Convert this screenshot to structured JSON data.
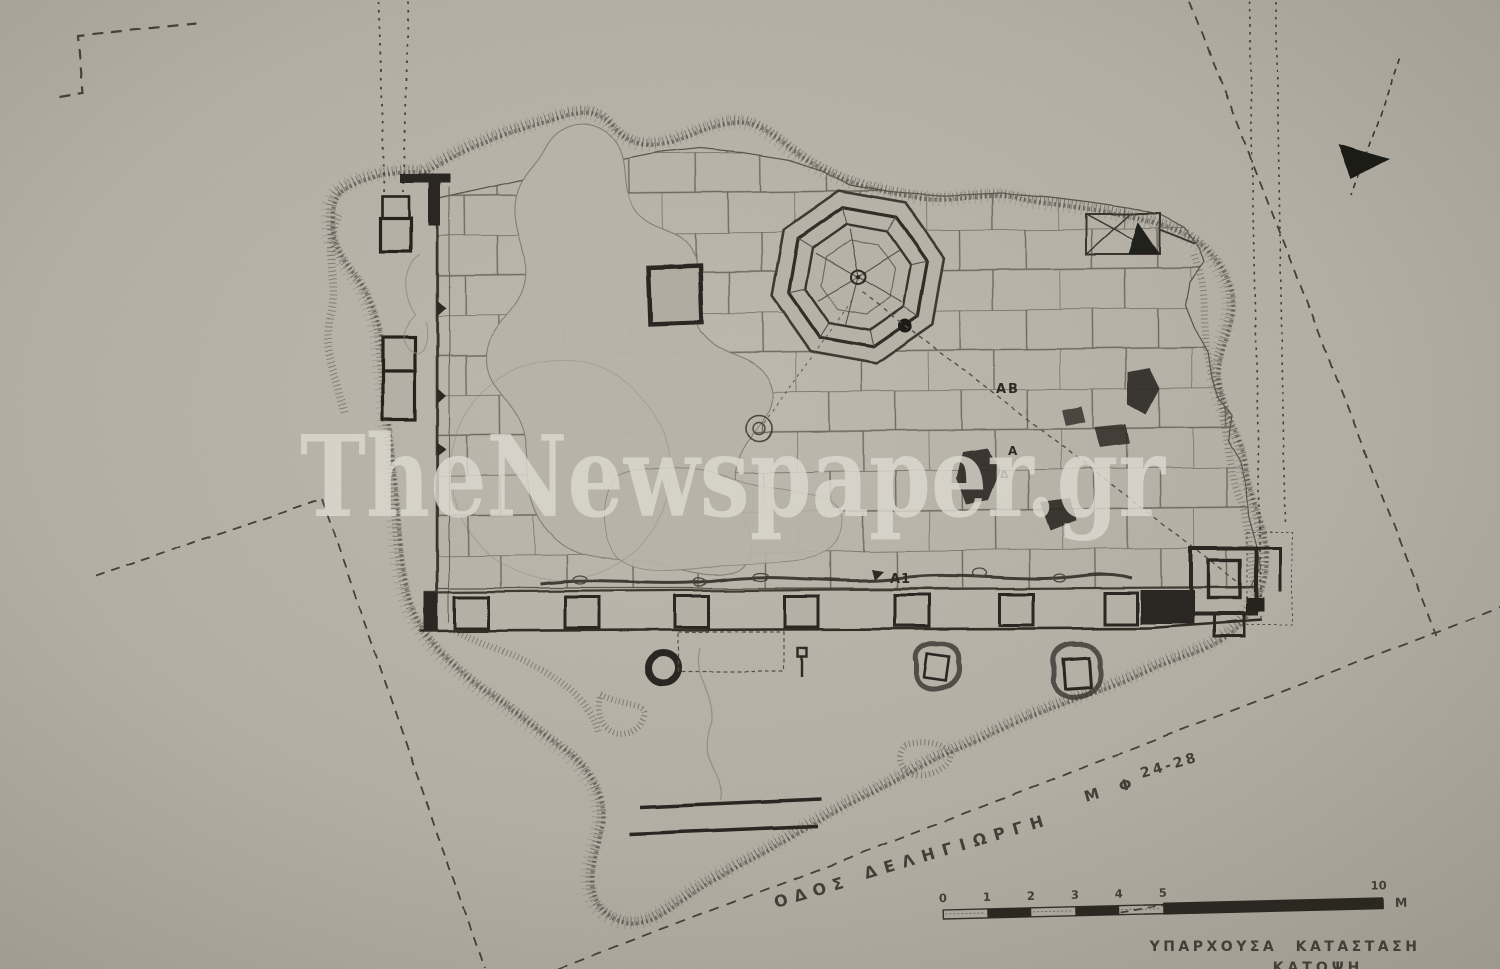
{
  "watermark": {
    "text": "TheNewspaper.gr"
  },
  "captions": {
    "line1": "ΥΠΑΡΧΟΥΣΑ ΚΑΤΑΣΤΑΣΗ",
    "line2": "ΚΑΤΟΨΗ"
  },
  "street_label": {
    "part1": "ΟΔΟΣ",
    "part2": "ΔΕΛΗΓΙΩΡΓΗ",
    "part3": "Μ Φ",
    "part4": "24-28"
  },
  "plan_labels": {
    "ab": "ΑΒ",
    "a": "Α",
    "delta": "Δ",
    "a1": "Α1"
  },
  "scale_bar": {
    "ticks": [
      "0",
      "1",
      "2",
      "3",
      "4",
      "5",
      "10"
    ],
    "unit": "Μ"
  },
  "icons": {
    "north_arrow": "north-arrow-icon"
  },
  "colors": {
    "paper": "#b8b3a9",
    "ink": "#3b372f",
    "ink_dark": "#26231d",
    "ink_faint": "#8d887c",
    "watermark": "#dcd9d0"
  }
}
